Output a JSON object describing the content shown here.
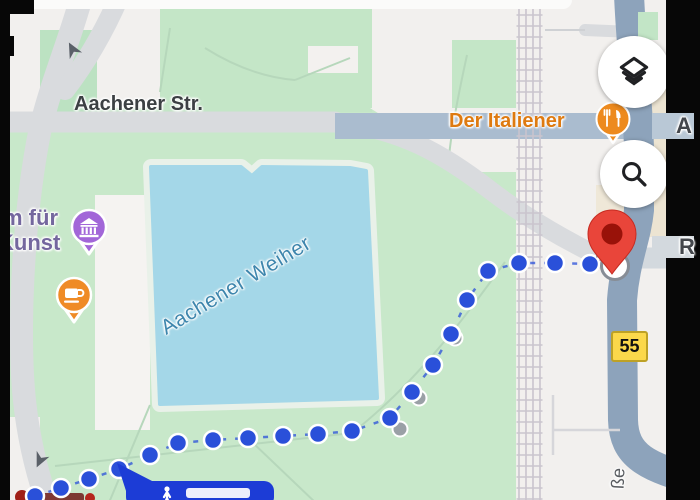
{
  "app": {
    "name": "maps-walking-route-view"
  },
  "labels": {
    "street_main": "Aachener Str.",
    "poi_restaurant": "Der Italiener",
    "poi_museum_line1": "m für",
    "poi_museum_line2": "Kunst",
    "lake": "Aachener Weiher",
    "road_badge": "55",
    "street_right_top_partial": "A",
    "street_right_mid_partial": "R",
    "street_bottom_partial": "ße"
  },
  "icons": {
    "layers": "layers-icon",
    "search": "search-icon",
    "restaurant": "fork-knife-icon",
    "museum": "museum-building-icon",
    "cafe": "coffee-cup-icon",
    "destination": "red-map-pin",
    "walking": "walking-person-icon",
    "oneway": "one-way-arrow-icon"
  },
  "colors": {
    "route_blue": "#2a50d9",
    "route_dot_gray": "#9aa0a6",
    "pin_red": "#e9453a",
    "pin_inner_red": "#991209",
    "badge_yellow": "#fbd84b",
    "badge_border": "#bda126",
    "restaurant_orange": "#ed8a1e",
    "museum_purple": "#a266d8",
    "label_orange": "#de7a10",
    "label_purple": "#74679e",
    "lake_blue": "#a4d7e8",
    "lake_label_blue": "#3e86ad",
    "park_green": "#c8e8ca",
    "road_major_bluegray": "#8da3bb",
    "callout_blue": "#1c3cd6"
  },
  "route": {
    "blue_dots": [
      [
        35,
        496
      ],
      [
        61,
        488
      ],
      [
        89,
        479
      ],
      [
        119,
        469
      ],
      [
        150,
        455
      ],
      [
        178,
        443
      ],
      [
        213,
        440
      ],
      [
        248,
        438
      ],
      [
        283,
        436
      ],
      [
        318,
        434
      ],
      [
        352,
        431
      ],
      [
        390,
        418
      ],
      [
        412,
        392
      ],
      [
        433,
        365
      ],
      [
        451,
        334
      ],
      [
        467,
        300
      ],
      [
        488,
        271
      ],
      [
        519,
        263
      ],
      [
        555,
        263
      ],
      [
        590,
        264
      ]
    ],
    "gray_dots": [
      [
        400,
        429
      ],
      [
        419,
        398
      ],
      [
        455,
        338
      ]
    ]
  }
}
